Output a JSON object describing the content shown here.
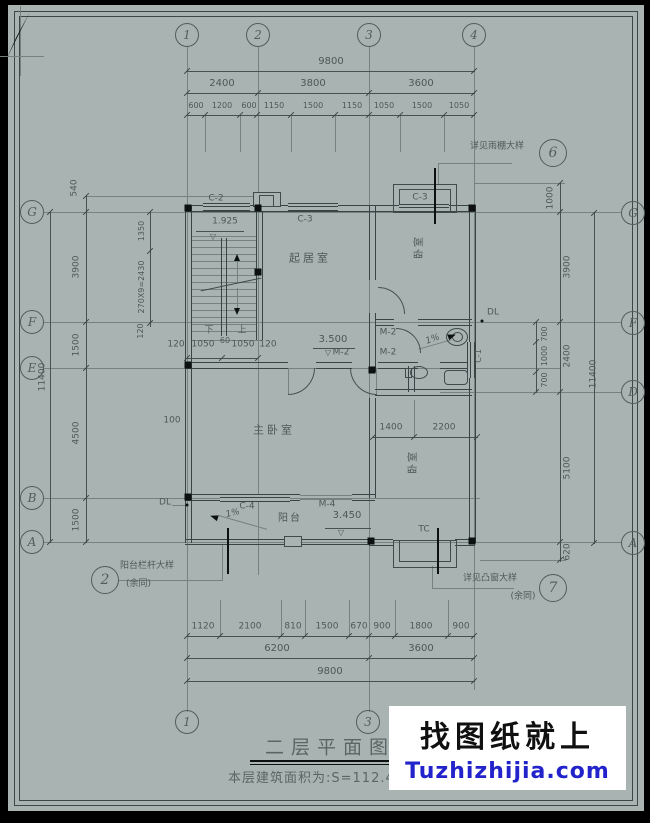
{
  "colors": {
    "paper": "#a9b4b2",
    "line": "#46524f",
    "wall": "#394544",
    "heavy": "#0c1110",
    "text": "#4d5857",
    "watermark_blue": "#2323cb"
  },
  "watermark": {
    "line1": "找图纸就上",
    "line2": "Tuzhizhijia.com"
  },
  "titleblock": {
    "title": "二层平面图",
    "area_note": "本层建筑面积为:S=112.4平方米"
  },
  "grid": {
    "top": [
      "1",
      "2",
      "3",
      "4"
    ],
    "bottom": [
      "1",
      "3",
      "4"
    ],
    "left": [
      "G",
      "F",
      "E",
      "B",
      "A"
    ],
    "right": [
      "G",
      "F",
      "D",
      "A"
    ]
  },
  "refs": {
    "canopy": {
      "label": "详见雨棚大样",
      "num": "6"
    },
    "rail": {
      "label": "阳台栏杆大样",
      "sub": "(余同)",
      "num": "2"
    },
    "bay": {
      "label": "详见凸窗大样",
      "sub": "(余同)",
      "num": "7"
    }
  },
  "rooms": {
    "living": "起居室",
    "master": "主卧室",
    "bed_ne": "卧室",
    "bed_se": "卧室",
    "balcony": "阳台"
  },
  "tags": {
    "c2": "C-2",
    "c3_mid": "C-3",
    "c3_ne": "C-3",
    "c4": "C-4",
    "c1": "C-1",
    "m2": "M-2",
    "m4": "M-4",
    "tc": "TC",
    "dl": "DL"
  },
  "levels": {
    "stair": "1.925",
    "floor": "3.500",
    "balcony": "3.450"
  },
  "stair": {
    "down": "下",
    "up": "上",
    "mid": "60"
  },
  "slope": "1%",
  "dims": {
    "top_overall": "9800",
    "top_mid": [
      "2400",
      "3800",
      "3600"
    ],
    "top_fine": [
      "600",
      "1200",
      "600",
      "1150",
      "1500",
      "1150",
      "1050",
      "1500",
      "1050"
    ],
    "bottom_fine": [
      "1120",
      "2100",
      "810",
      "1500",
      "670",
      "900",
      "1800",
      "900"
    ],
    "bottom_mid": [
      "6200",
      "3600"
    ],
    "bottom_overall": "9800",
    "left_offset": "540",
    "left_tier": [
      "3900",
      "1500",
      "4500",
      "1500"
    ],
    "left_overall": "11400",
    "left_inner": [
      "1350",
      "270X9=2430",
      "120"
    ],
    "stair_dims": [
      "120",
      "1050",
      "60",
      "1050",
      "120"
    ],
    "inner_100": "100",
    "right_offset": "1000",
    "right_tier": [
      "3900",
      "2400",
      "5100"
    ],
    "right_sub": [
      "700",
      "1000",
      "700"
    ],
    "right_overall": "11400",
    "right_bottom": "620",
    "inner_mid": [
      "1400",
      "2200"
    ]
  }
}
